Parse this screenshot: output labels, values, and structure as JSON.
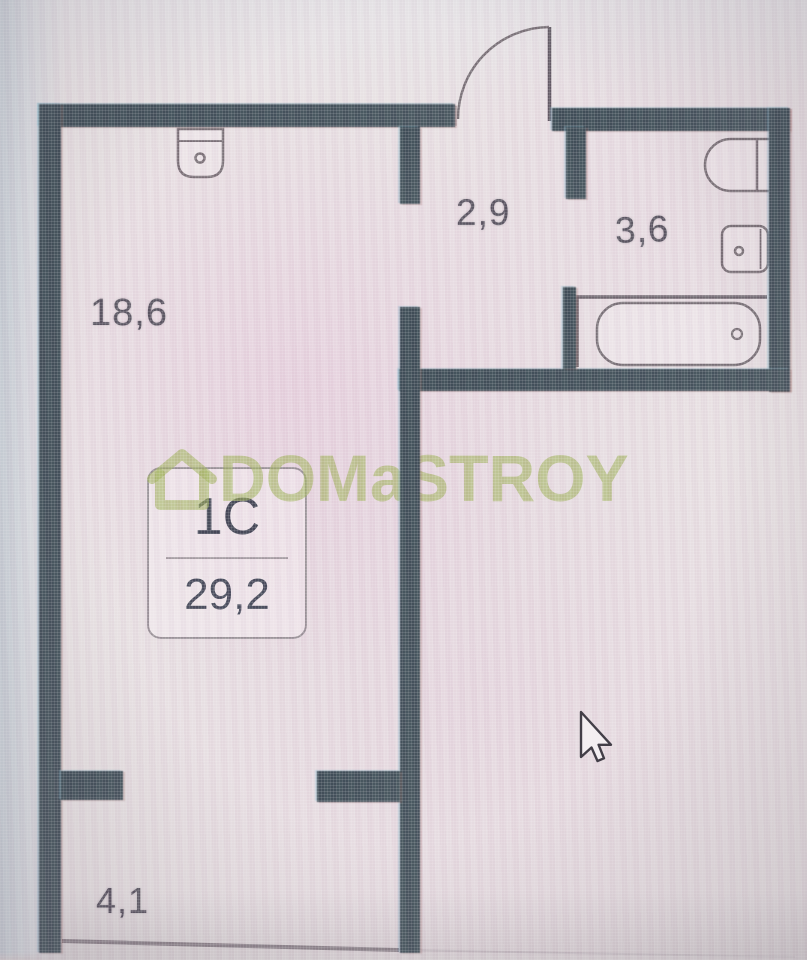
{
  "floorplan": {
    "unit_card": {
      "type": "1C",
      "area": "29,2"
    },
    "labels": {
      "living_room": "18,6",
      "hallway": "2,9",
      "bathroom": "3,6",
      "balcony": "4,1"
    },
    "watermark": {
      "text": "DOMaSTROY",
      "color": "#9fb35a"
    },
    "fixtures": [
      "kitchen-sink",
      "toilet",
      "washbasin",
      "bathtub",
      "entrance-door"
    ],
    "cursor": "arrow-pointer",
    "colors": {
      "wall": "#3e4e57",
      "fixture_outline": "#756d73",
      "label_text": "#55515d",
      "background": "#e7e0e2"
    }
  }
}
